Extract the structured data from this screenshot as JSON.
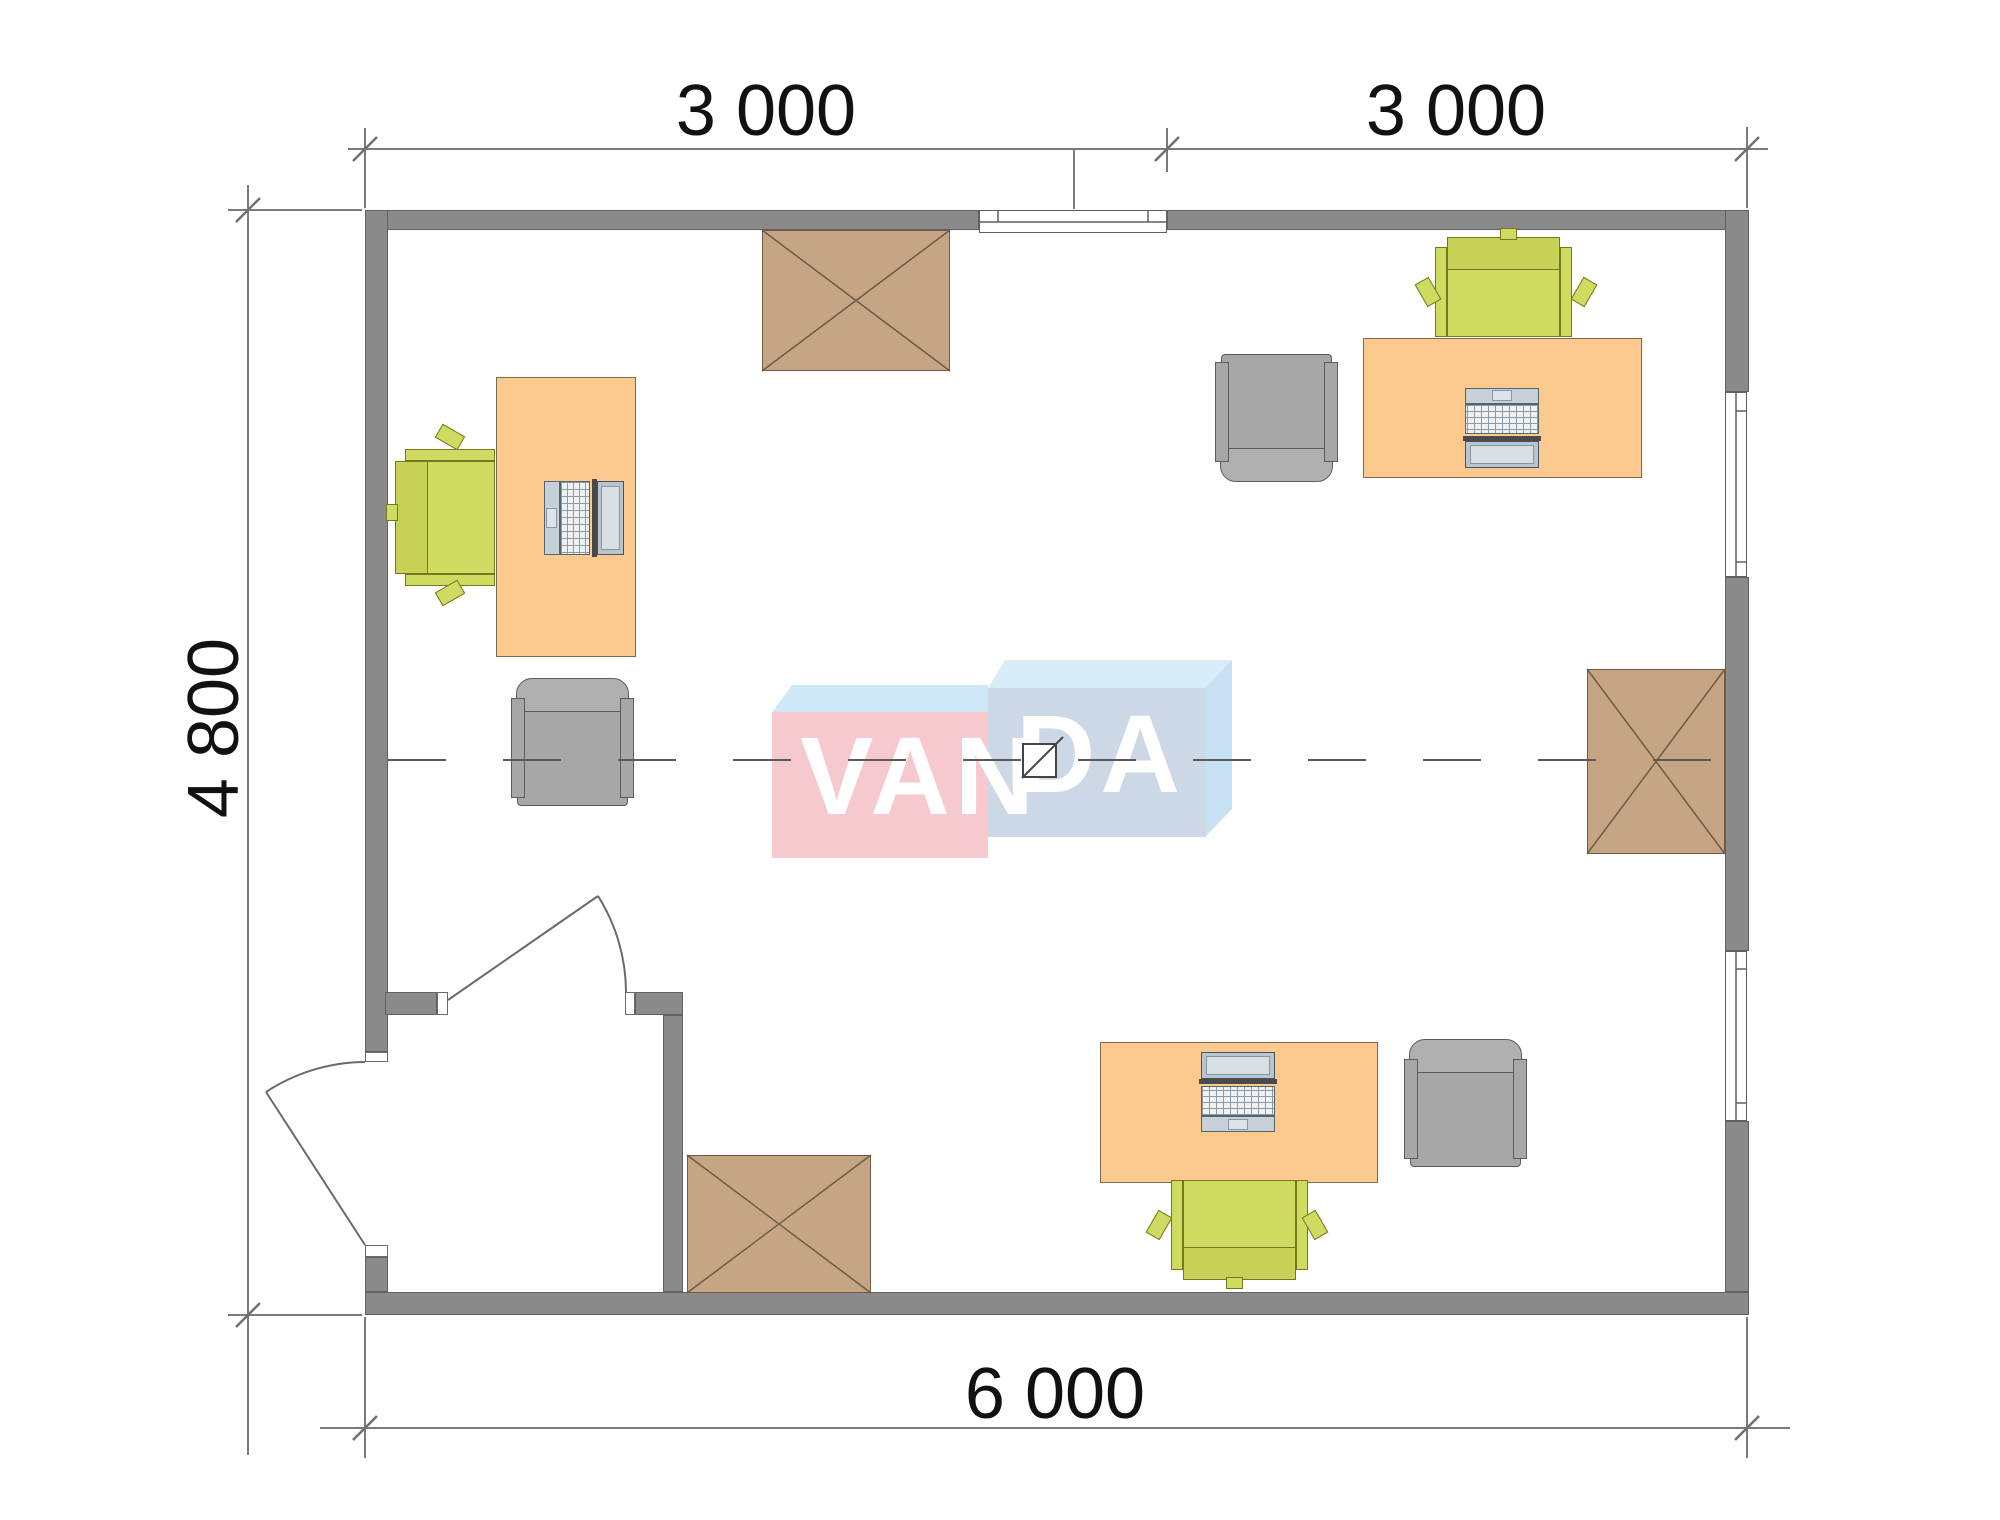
{
  "drawing": {
    "type": "office floor plan, top view",
    "watermark": {
      "text": "VANDA",
      "part1": "VAN",
      "part2": "DA"
    },
    "dimensions": {
      "top_left_label": "3 000",
      "top_right_label": "3 000",
      "left_label": "4 800",
      "bottom_label": "6 000"
    },
    "rooms": [
      {
        "name": "main office",
        "width_mm": 6000,
        "depth_mm": 4800
      },
      {
        "name": "entry lobby (bottom-left, partitioned, two doors)"
      }
    ],
    "furniture": [
      {
        "type": "desk with laptop and task chair",
        "location": "left wall"
      },
      {
        "type": "desk with laptop and task chair",
        "location": "top-right"
      },
      {
        "type": "desk with laptop and task chair",
        "location": "bottom-center"
      },
      {
        "type": "gray armchair",
        "location": "center-left"
      },
      {
        "type": "gray armchair",
        "location": "center-right"
      },
      {
        "type": "gray armchair",
        "location": "bottom-right"
      },
      {
        "type": "crossed square table/cabinet",
        "location": "top wall"
      },
      {
        "type": "crossed square table/cabinet",
        "location": "right wall"
      },
      {
        "type": "crossed square table/cabinet",
        "location": "lobby partition"
      }
    ],
    "openings": [
      {
        "type": "window",
        "location": "top wall"
      },
      {
        "type": "window",
        "location": "right wall upper"
      },
      {
        "type": "window",
        "location": "right wall lower"
      },
      {
        "type": "door",
        "location": "left wall exterior, opens outward"
      },
      {
        "type": "door",
        "location": "interior partition, opens into office"
      }
    ],
    "colors": {
      "wall": "#8a8a8a",
      "desk": "#fcc98f",
      "task_chair": "#cfda60",
      "armchair": "#a7a7a7",
      "crossed_table": "#c6a585",
      "logo_pink": "#f6c9ce",
      "logo_blue_front": "#ccd8e5",
      "logo_blue_top": "#d9edf9",
      "dim_lines": "#7b7b7b"
    }
  }
}
